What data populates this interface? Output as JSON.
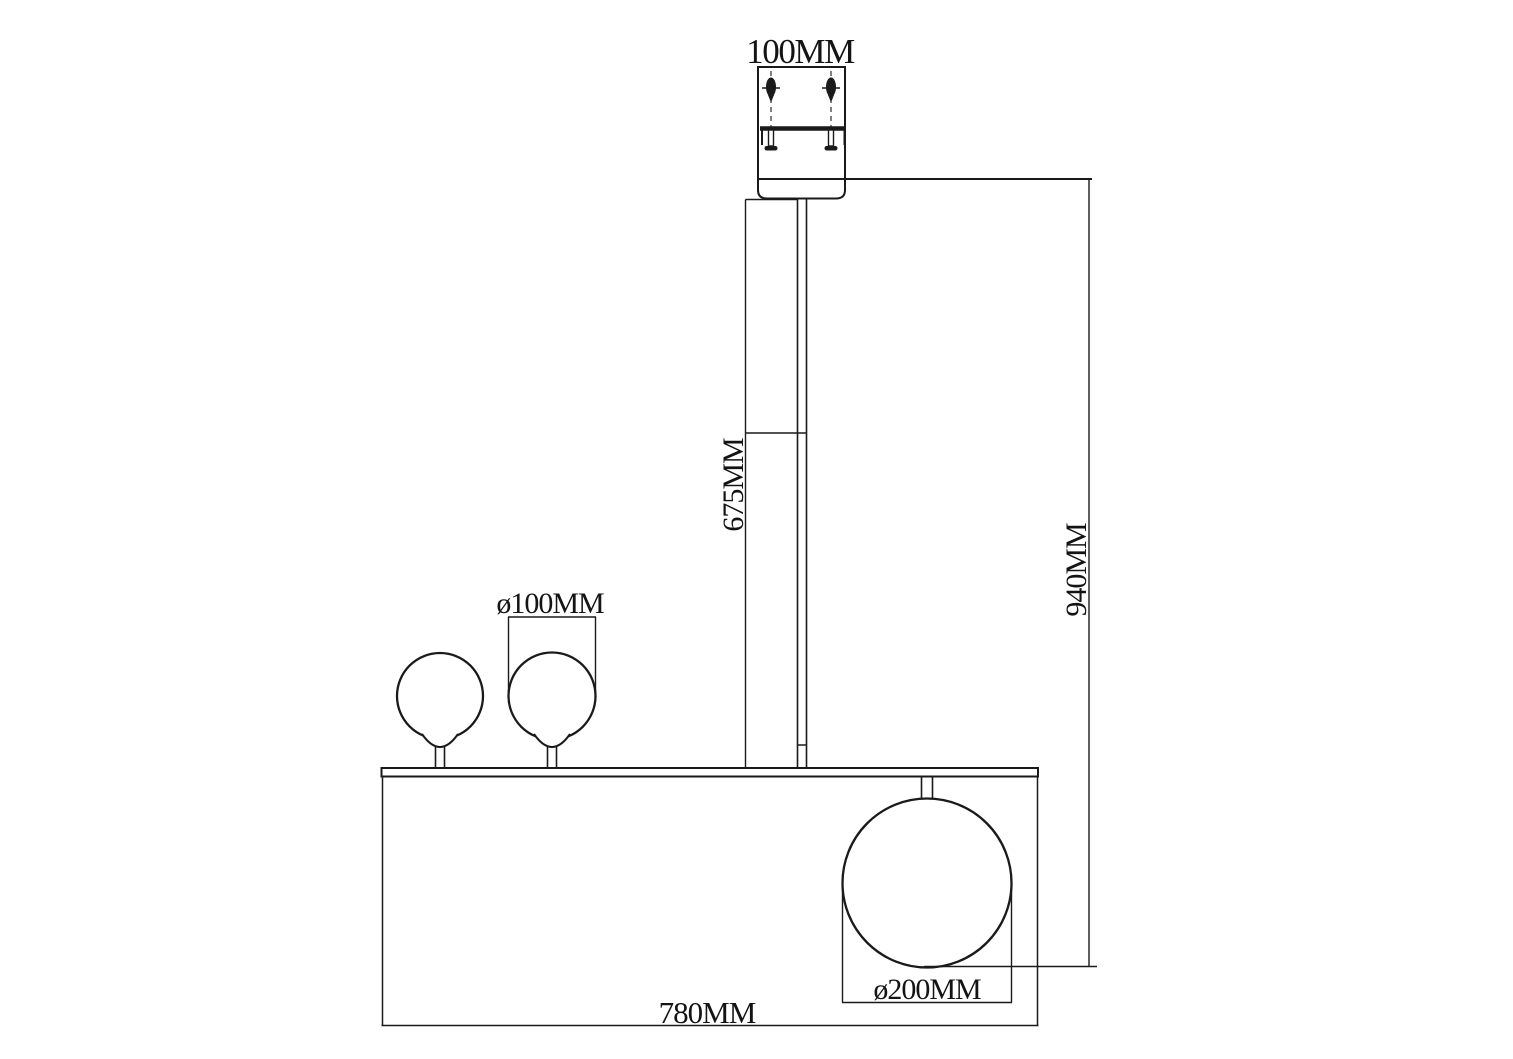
{
  "drawing": {
    "background_color": "#ffffff",
    "line_color": "#1a1a1a",
    "dimensions": {
      "canopy_width": "100MM",
      "rod_length": "675MM",
      "overall_drop": "940MM",
      "small_globe_diameter": "ø100MM",
      "large_globe_diameter": "ø200MM",
      "bar_length": "780MM"
    }
  }
}
